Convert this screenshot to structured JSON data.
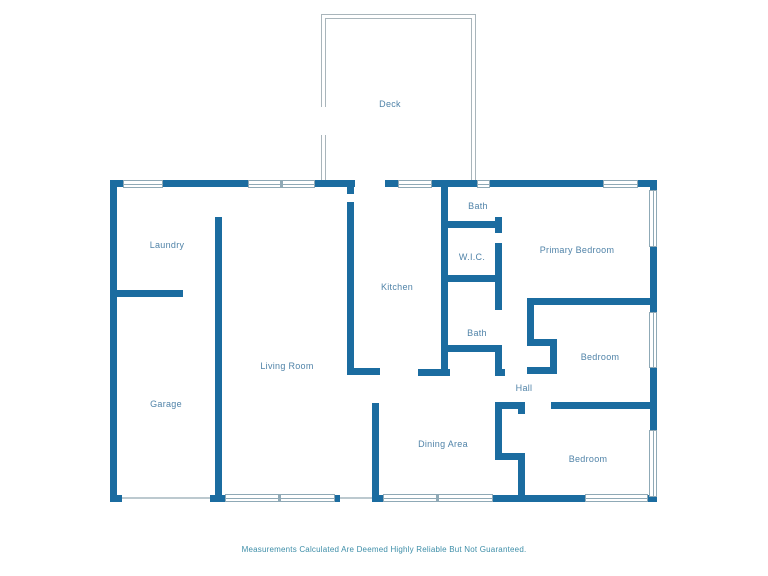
{
  "plan": {
    "colors": {
      "wall": "#1b6ca0",
      "room_label": "#5083a8",
      "deck_outline": "#a9b5bb",
      "window_border": "#8fa9b6",
      "opening_line": "#bcc9cf",
      "disclaimer_text_color": "#3e8ea8",
      "background": "#ffffff"
    },
    "rooms": [
      {
        "label": "Deck",
        "x": 390,
        "y": 104
      },
      {
        "label": "Laundry",
        "x": 167,
        "y": 245
      },
      {
        "label": "Bath",
        "x": 478,
        "y": 206
      },
      {
        "label": "W.I.C.",
        "x": 472,
        "y": 257
      },
      {
        "label": "Primary Bedroom",
        "x": 577,
        "y": 250
      },
      {
        "label": "Kitchen",
        "x": 397,
        "y": 287
      },
      {
        "label": "Bath",
        "x": 477,
        "y": 333
      },
      {
        "label": "Living Room",
        "x": 287,
        "y": 366
      },
      {
        "label": "Bedroom",
        "x": 600,
        "y": 357
      },
      {
        "label": "Hall",
        "x": 524,
        "y": 388
      },
      {
        "label": "Garage",
        "x": 166,
        "y": 404
      },
      {
        "label": "Dining Area",
        "x": 443,
        "y": 444
      },
      {
        "label": "Bedroom",
        "x": 588,
        "y": 459
      }
    ],
    "walls": [
      [
        110,
        180,
        13,
        7
      ],
      [
        163,
        180,
        85,
        7
      ],
      [
        315,
        180,
        40,
        7
      ],
      [
        385,
        180,
        13,
        7
      ],
      [
        432,
        180,
        45,
        7
      ],
      [
        490,
        180,
        113,
        7
      ],
      [
        638,
        180,
        19,
        7
      ],
      [
        110,
        180,
        7,
        322
      ],
      [
        650,
        180,
        7,
        10
      ],
      [
        650,
        247,
        7,
        65
      ],
      [
        650,
        368,
        7,
        62
      ],
      [
        650,
        497,
        7,
        5
      ],
      [
        110,
        495,
        12,
        7
      ],
      [
        210,
        495,
        15,
        7
      ],
      [
        335,
        495,
        5,
        7
      ],
      [
        372,
        495,
        11,
        7
      ],
      [
        493,
        495,
        92,
        7
      ],
      [
        648,
        495,
        9,
        7
      ],
      [
        215,
        217,
        7,
        278
      ],
      [
        110,
        290,
        73,
        7
      ],
      [
        347,
        187,
        7,
        7
      ],
      [
        347,
        202,
        7,
        172
      ],
      [
        347,
        368,
        33,
        7
      ],
      [
        372,
        403,
        7,
        92
      ],
      [
        441,
        187,
        7,
        188
      ],
      [
        441,
        221,
        61,
        7
      ],
      [
        441,
        275,
        61,
        7
      ],
      [
        441,
        345,
        61,
        7
      ],
      [
        495,
        217,
        7,
        16
      ],
      [
        495,
        243,
        7,
        67
      ],
      [
        495,
        345,
        7,
        31
      ],
      [
        418,
        369,
        32,
        7
      ],
      [
        495,
        369,
        10,
        7
      ],
      [
        527,
        298,
        130,
        7
      ],
      [
        527,
        305,
        7,
        41
      ],
      [
        527,
        339,
        30,
        7
      ],
      [
        550,
        339,
        7,
        35
      ],
      [
        527,
        367,
        30,
        7
      ],
      [
        495,
        402,
        30,
        7
      ],
      [
        518,
        402,
        7,
        12
      ],
      [
        551,
        402,
        106,
        7
      ],
      [
        495,
        402,
        7,
        58
      ],
      [
        495,
        453,
        30,
        7
      ],
      [
        518,
        453,
        7,
        42
      ]
    ],
    "windows": [
      {
        "x": 123,
        "y": 180,
        "w": 40,
        "h": 8,
        "o": "h",
        "div": false
      },
      {
        "x": 248,
        "y": 180,
        "w": 67,
        "h": 8,
        "o": "h",
        "div": true
      },
      {
        "x": 398,
        "y": 180,
        "w": 34,
        "h": 8,
        "o": "h",
        "div": false
      },
      {
        "x": 477,
        "y": 180,
        "w": 13,
        "h": 8,
        "o": "h",
        "div": false
      },
      {
        "x": 603,
        "y": 180,
        "w": 35,
        "h": 8,
        "o": "h",
        "div": false
      },
      {
        "x": 649,
        "y": 190,
        "w": 8,
        "h": 57,
        "o": "v",
        "div": false
      },
      {
        "x": 649,
        "y": 312,
        "w": 8,
        "h": 56,
        "o": "v",
        "div": false
      },
      {
        "x": 649,
        "y": 430,
        "w": 8,
        "h": 67,
        "o": "v",
        "div": false
      },
      {
        "x": 225,
        "y": 494,
        "w": 110,
        "h": 8,
        "o": "h",
        "div": true
      },
      {
        "x": 383,
        "y": 494,
        "w": 110,
        "h": 8,
        "o": "h",
        "div": true
      },
      {
        "x": 585,
        "y": 494,
        "w": 63,
        "h": 8,
        "o": "h",
        "div": false
      }
    ],
    "openings": [
      [
        122,
        497,
        88,
        2
      ],
      [
        340,
        497,
        32,
        2
      ]
    ],
    "deck": {
      "outer": {
        "x": 321,
        "y": 14,
        "w": 155,
        "h": 166
      },
      "inner": {
        "x": 325,
        "y": 18,
        "w": 147,
        "h": 162
      },
      "gap": {
        "x": 319,
        "y": 107,
        "w": 9,
        "h": 28
      }
    },
    "disclaimer": {
      "text": "Measurements Calculated Are Deemed Highly Reliable But Not Guaranteed."
    }
  }
}
